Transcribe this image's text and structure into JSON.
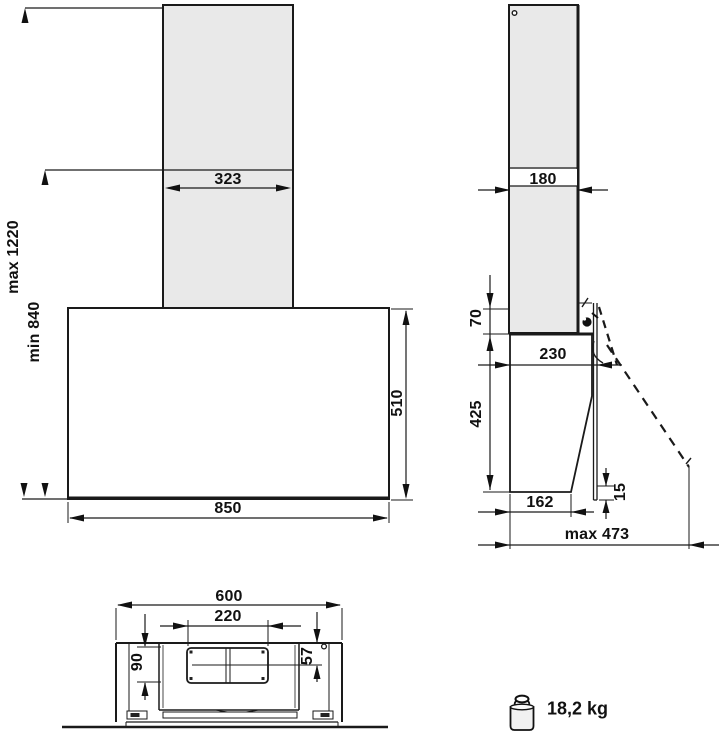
{
  "diagram": {
    "title_hint": "cooker hood installation dimensions drawing",
    "front_view": {
      "chimney_width": "323",
      "body_width": "850",
      "body_height": "510",
      "install_height_max": "max 1220",
      "install_height_min": "min 840"
    },
    "side_view": {
      "chimney_depth": "180",
      "panel_above_body": "70",
      "depth_top": "230",
      "body_height": "425",
      "depth_bottom": "162",
      "panel_bottom_offset": "15",
      "open_panel_depth": "max 473"
    },
    "bottom_view": {
      "hood_width": "600",
      "duct_cutout_width": "220",
      "duct_cutout_depth": "90",
      "duct_center_offset": "57"
    },
    "weight": {
      "value": "18,2 kg"
    },
    "colors": {
      "line": "#1a1a1a",
      "chimney_fill": "#e9e9e9",
      "background": "#ffffff"
    }
  }
}
